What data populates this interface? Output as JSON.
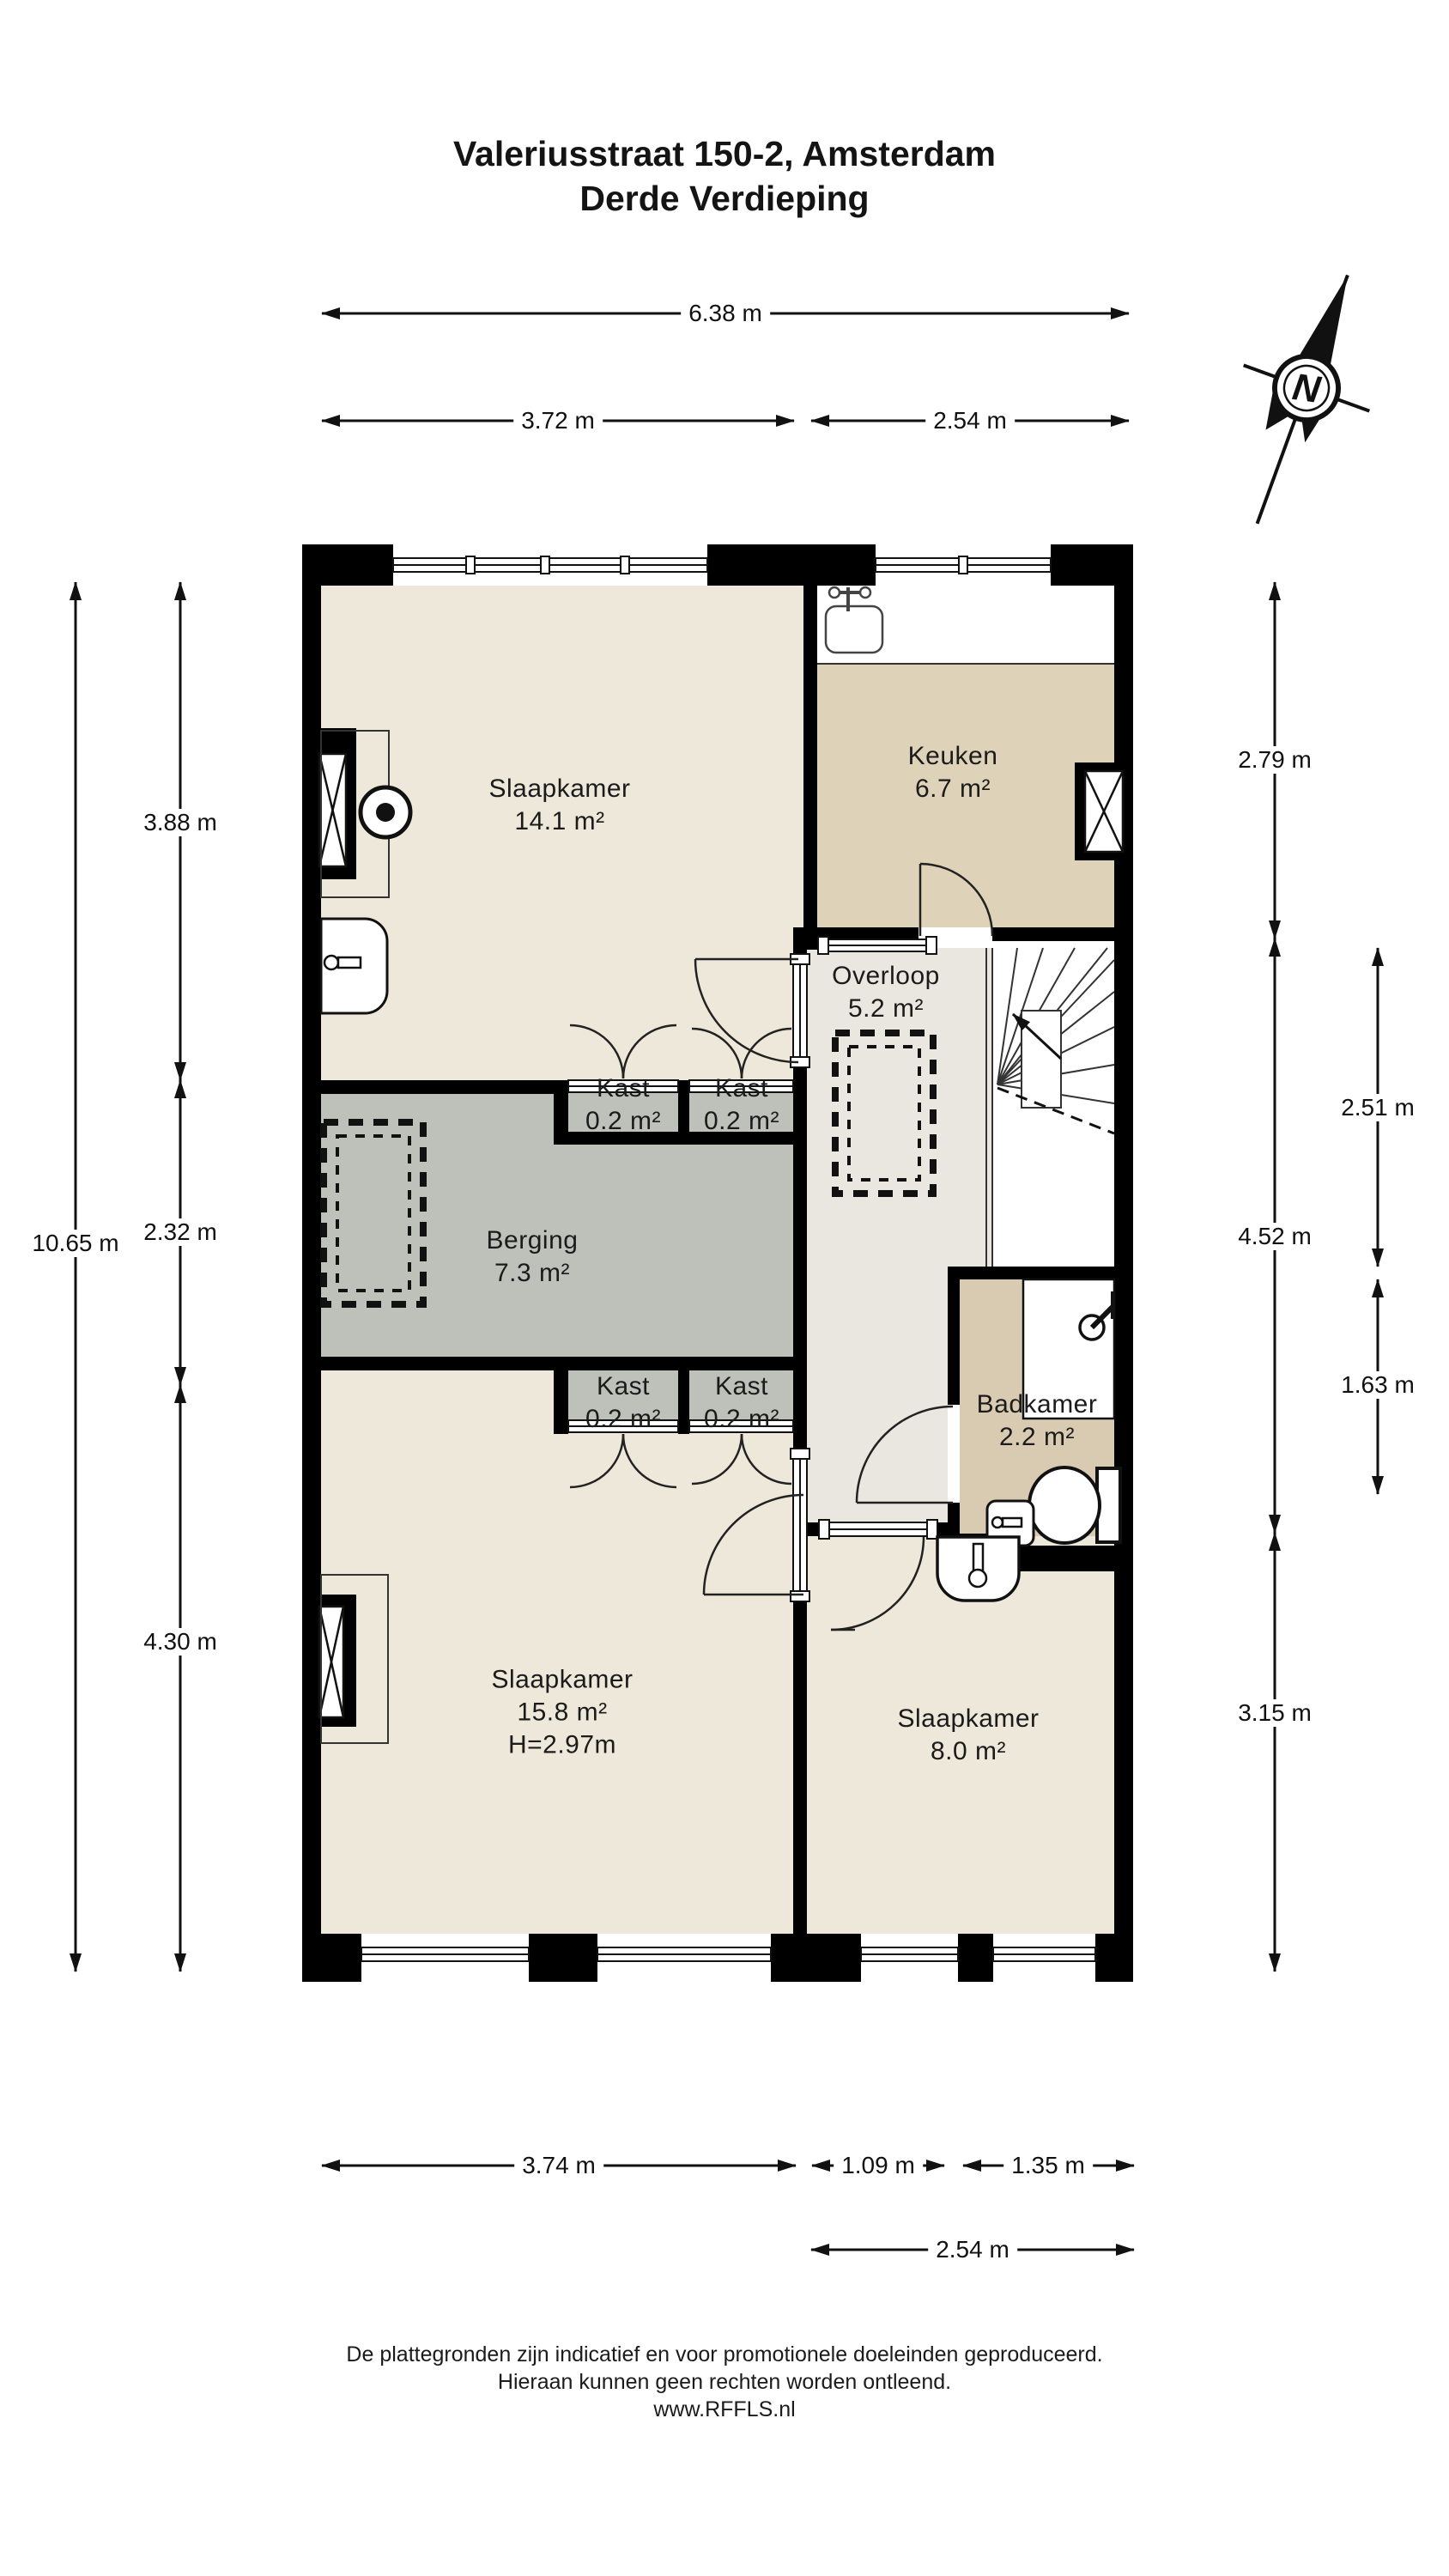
{
  "title": {
    "line1": "Valeriusstraat 150-2, Amsterdam",
    "line2": "Derde Verdieping"
  },
  "compass": {
    "letter": "N"
  },
  "rooms": [
    {
      "name": "Slaapkamer",
      "area": "14.1 m²"
    },
    {
      "name": "Keuken",
      "area": "6.7 m²"
    },
    {
      "name": "Overloop",
      "area": "5.2 m²"
    },
    {
      "name": "Kast",
      "area": "0.2 m²"
    },
    {
      "name": "Kast",
      "area": "0.2 m²"
    },
    {
      "name": "Berging",
      "area": "7.3 m²"
    },
    {
      "name": "Kast",
      "area": "0.2 m²"
    },
    {
      "name": "Kast",
      "area": "0.2 m²"
    },
    {
      "name": "Badkamer",
      "area": "2.2 m²"
    },
    {
      "name": "Slaapkamer",
      "area": "15.8 m²",
      "height": "H=2.97m"
    },
    {
      "name": "Slaapkamer",
      "area": "8.0 m²"
    }
  ],
  "dimensions": {
    "top": [
      "6.38 m",
      "3.72 m",
      "2.54 m"
    ],
    "left": [
      "10.65 m",
      "3.88 m",
      "2.32 m",
      "4.30 m"
    ],
    "right": [
      "2.79 m",
      "2.51 m",
      "4.52 m",
      "1.63 m",
      "3.15 m"
    ],
    "bottom": [
      "3.74 m",
      "1.09 m",
      "1.35 m",
      "2.54 m"
    ]
  },
  "footer": {
    "line1": "De plattegronden zijn indicatief en voor promotionele doeleinden geproduceerd.",
    "line2": "Hieraan kunnen geen rechten worden ontleend.",
    "line3": "www.RFFLS.nl"
  },
  "colors": {
    "wall": "#000000",
    "bedroom_floor": "#EDE8DA",
    "kitchen_floor": "#DED2B9",
    "bathroom_floor": "#D9CBB2",
    "storage_floor": "#BEC1BA",
    "hall_floor": "#E9E7DF",
    "line": "#1A1A1A"
  }
}
